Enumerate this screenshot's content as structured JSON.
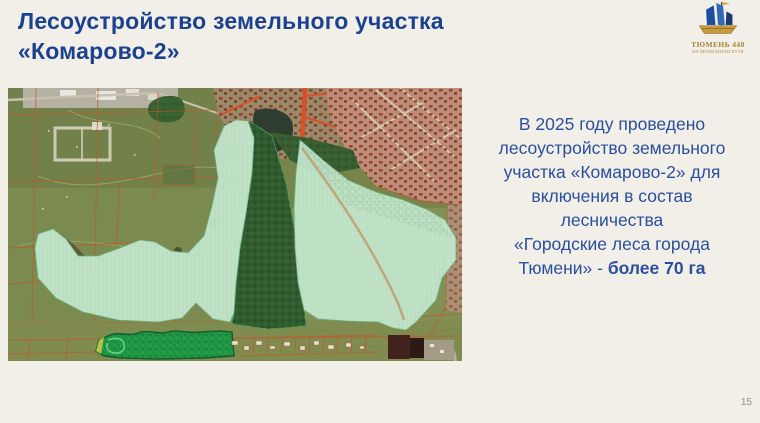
{
  "slide": {
    "title_lines": [
      "Лесоустройство земельного участка",
      "«Комарово-2»"
    ],
    "page_number": "15"
  },
  "logo": {
    "title": "ТЮМЕНЬ 440",
    "tagline": "НА ПРАВИЛЬНОМ ПУТИ"
  },
  "body": {
    "lines": [
      "В 2025 году проведено",
      "лесоустройство земельного",
      "участка «Комарово-2» для",
      "включения в состав",
      "лесничества",
      "«Городские леса города"
    ],
    "last_line_regular": "Тюмени» - ",
    "last_line_bold": "более 70 га"
  },
  "map": {
    "kind": "satellite-cadastral-map",
    "highlight_color": "#c3e7cd",
    "forest_patch_color": "#1fa04a",
    "cadastral_line_color": "#c2562e"
  },
  "colors": {
    "background": "#f2efe8",
    "title_text": "#1b4191",
    "body_text": "#2a4f9c",
    "page_number": "#8f8f88",
    "logo_gold": "#ab8134"
  }
}
